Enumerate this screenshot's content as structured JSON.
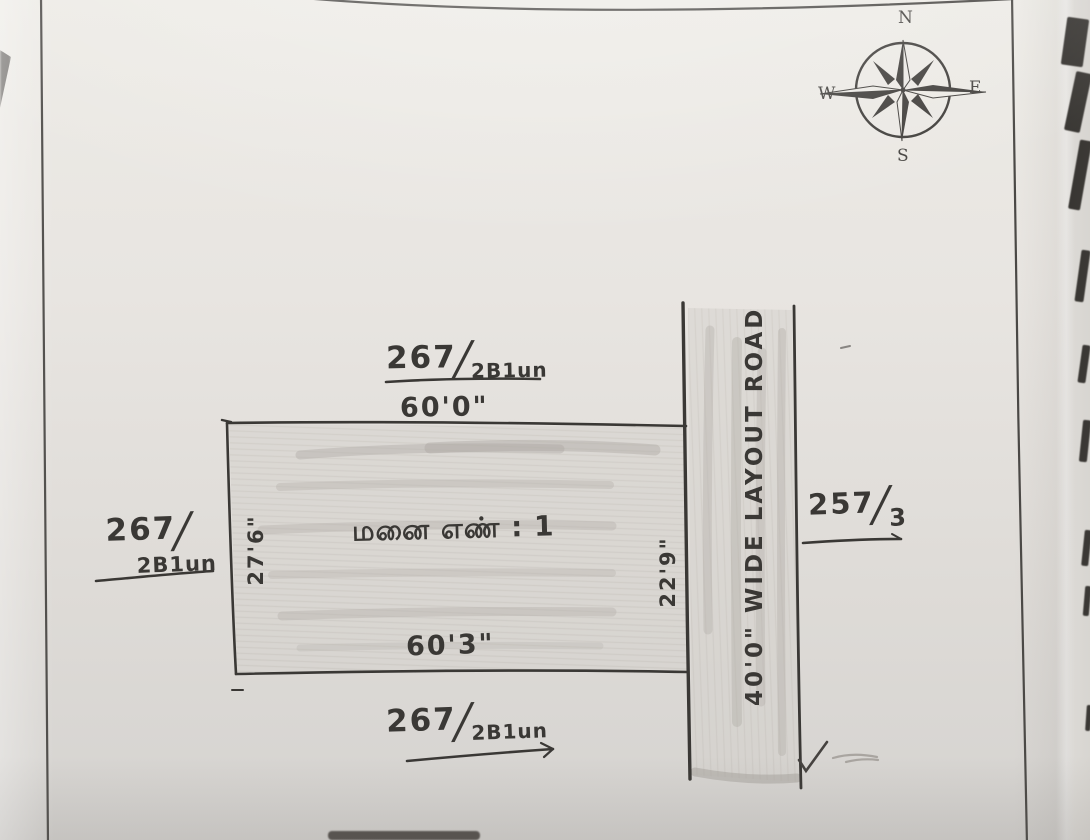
{
  "compass": {
    "north": "N",
    "east": "E",
    "south": "S",
    "west": "W"
  },
  "plot": {
    "name_tamil": "மனை எண் : 1",
    "top_width": "60'0\"",
    "bottom_width": "60'3\"",
    "left_depth": "27'6\"",
    "right_depth": "22'9\""
  },
  "adjacent_survey_numbers": {
    "north": {
      "num": "267",
      "slash": "/",
      "den": "2B1un"
    },
    "west": {
      "num": "267",
      "slash": "/",
      "den": "2B1un"
    },
    "south": {
      "num": "267",
      "slash": "/",
      "den": "2B1un"
    },
    "east": {
      "num": "257",
      "slash": "/",
      "den": "3"
    }
  },
  "road": {
    "label": "40'0\" WIDE LAYOUT ROAD"
  },
  "colors": {
    "ink": "#3a3835",
    "pencil_shading": "#cbc7c1",
    "paper": "#e6e3df"
  }
}
